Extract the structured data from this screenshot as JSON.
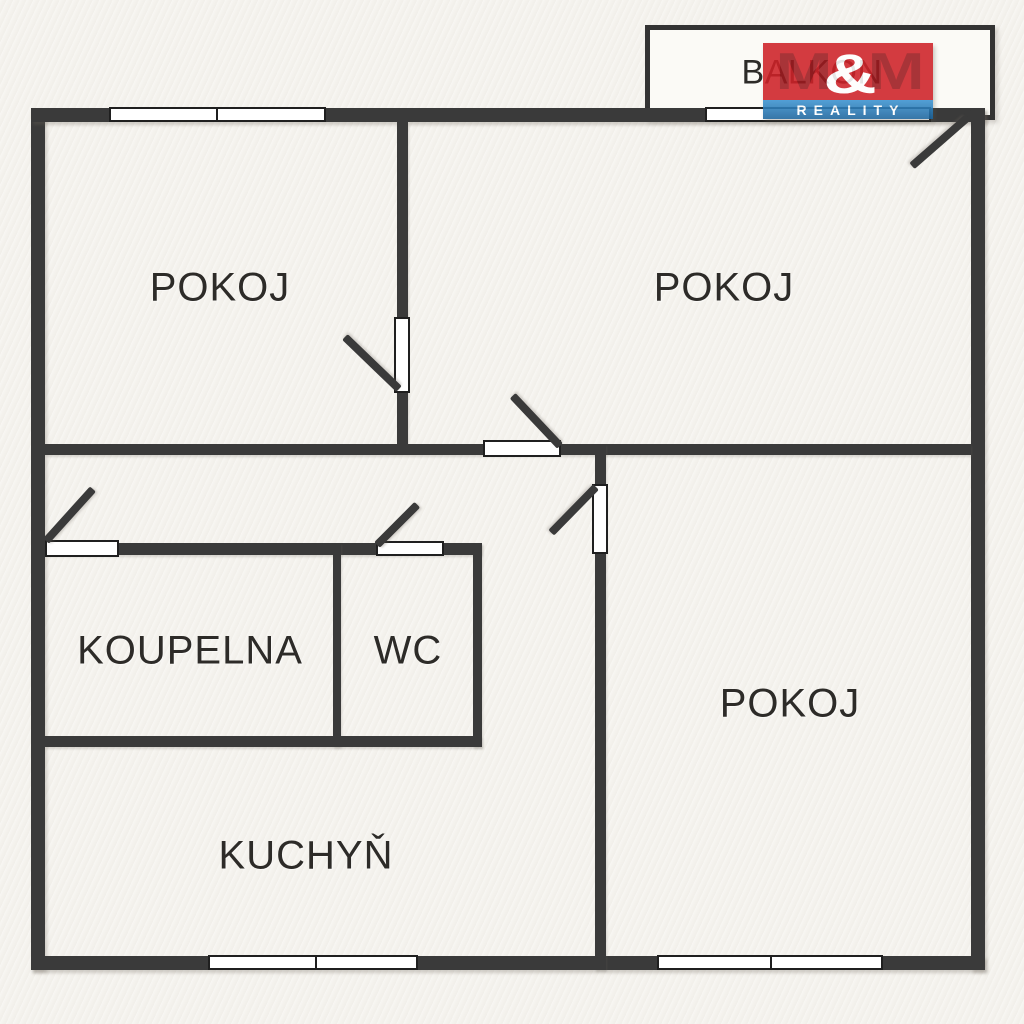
{
  "colors": {
    "bg": "#f4f2ed",
    "wall": "#3a3a3a",
    "line": "#1f1f1f",
    "window": "#ffffff",
    "text": "#2d2b28",
    "logo-red": "#ce2127",
    "logo-red-dark": "#9d191e",
    "logo-blue": "#3b93d2",
    "logo-blue-dark": "#1c649c",
    "logo-white": "#ffffff"
  },
  "rooms": {
    "pokoj_top_left": {
      "label": "POKOJ"
    },
    "pokoj_top_right": {
      "label": "POKOJ"
    },
    "pokoj_right": {
      "label": "POKOJ"
    },
    "koupelna": {
      "label": "KOUPELNA"
    },
    "wc": {
      "label": "WC"
    },
    "kuchyn": {
      "label": "KUCHYŇ"
    },
    "balkon": {
      "label": "BALKON"
    }
  },
  "logo": {
    "m1": "M",
    "amp": "&",
    "m2": "M",
    "subtitle": "REALITY"
  }
}
